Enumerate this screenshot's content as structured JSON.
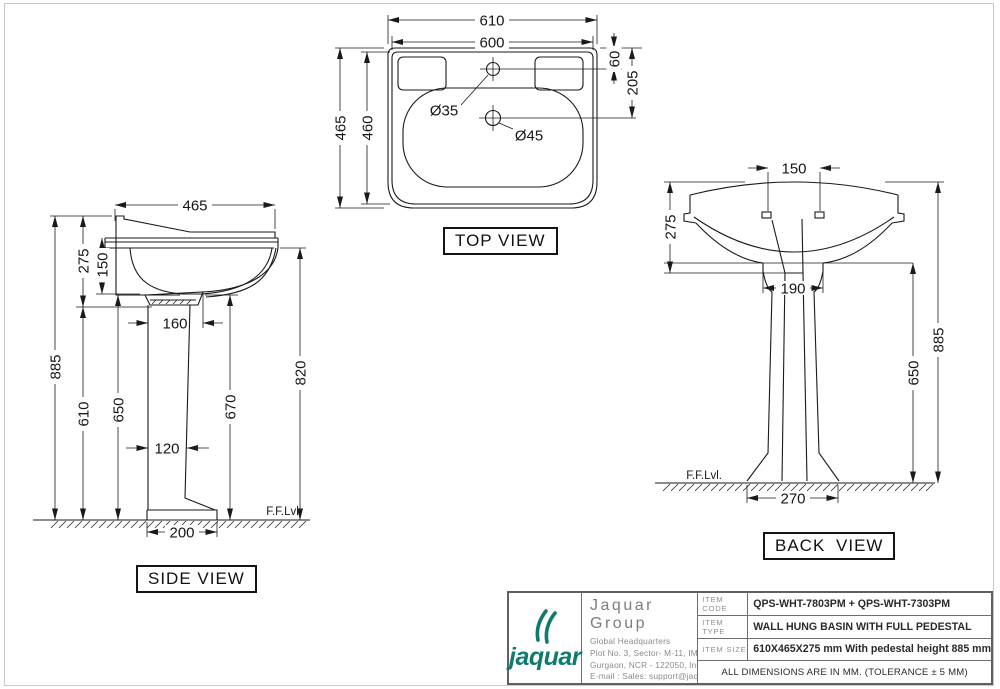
{
  "views": {
    "top": {
      "label": "TOP VIEW",
      "dims": {
        "outer_width": "610",
        "body_width": "600",
        "outer_depth": "465",
        "body_depth": "460",
        "tap_hole_offset": "60",
        "waste_hole_offset": "205",
        "tap_hole_dia": "Ø35",
        "waste_hole_dia": "Ø45"
      }
    },
    "side": {
      "label": "SIDE VIEW",
      "ffl": "F.F.Lvl.",
      "dims": {
        "basin_depth": "465",
        "basin_height": "275",
        "bowl_depth": "150",
        "drain_width": "160",
        "overall_height": "885",
        "lower_height": "610",
        "pedestal_height": "650",
        "pedestal_width": "120",
        "underside_height": "670",
        "rim_height": "820",
        "base_depth": "200"
      }
    },
    "back": {
      "label": "BACK VIEW",
      "ffl": "F.F.Lvl.",
      "dims": {
        "hole_spacing": "150",
        "basin_height": "275",
        "neck_width": "190",
        "pedestal_height": "650",
        "overall_height": "885",
        "base_width": "270"
      }
    }
  },
  "title_block": {
    "brand": {
      "wordmark": "jaquar",
      "color": "#0f7a6e"
    },
    "company": "Jaquar Group",
    "address_lines": [
      "Global Headquarters",
      "Plot No. 3, Sector- M-11, IMT Manesar",
      "Gurgaon, NCR - 122050, India",
      "E-mail : Sales: support@jaquar.com",
      "Customer Service : service@jaquar.com"
    ],
    "rows": [
      {
        "label": "ITEM CODE",
        "value": "QPS-WHT-7803PM + QPS-WHT-7303PM"
      },
      {
        "label": "ITEM TYPE",
        "value": "WALL HUNG BASIN WITH FULL PEDESTAL"
      },
      {
        "label": "ITEM SIZE",
        "value": "610X465X275 mm With pedestal height 885 mm"
      }
    ],
    "note": "ALL DIMENSIONS ARE IN MM. (TOLERANCE ± 5 MM)"
  }
}
